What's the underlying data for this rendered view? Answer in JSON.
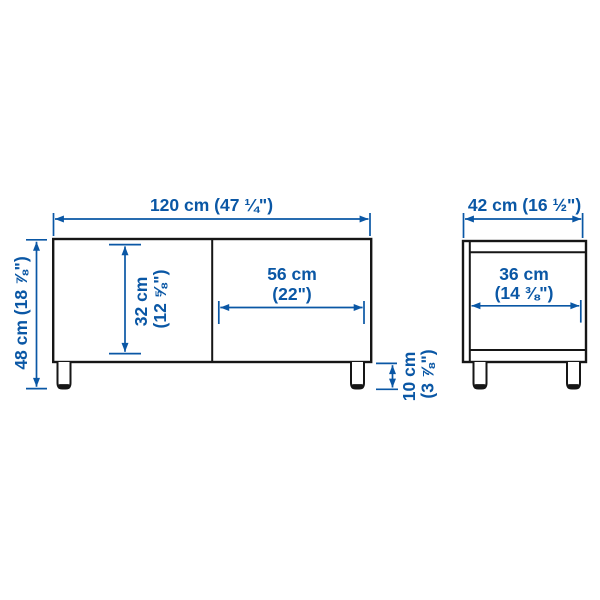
{
  "diagram": {
    "type": "furniture-dimension-drawing",
    "colors": {
      "dimension_blue": "#0a57a5",
      "outline_black": "#161616",
      "background": "#ffffff"
    },
    "front_view": {
      "overall_width": "120 cm (47 ¼\")",
      "overall_height": "48 cm (18 ⅞\")",
      "interior_height": [
        "32 cm",
        "(12 ⅝\")"
      ],
      "door_width": [
        "56 cm",
        "(22\")"
      ],
      "leg_height": [
        "10 cm",
        "(3 ⅞\")"
      ]
    },
    "side_view": {
      "overall_depth": "42 cm (16 ½\")",
      "interior_depth": [
        "36 cm",
        "(14 ⅜\")"
      ]
    }
  }
}
